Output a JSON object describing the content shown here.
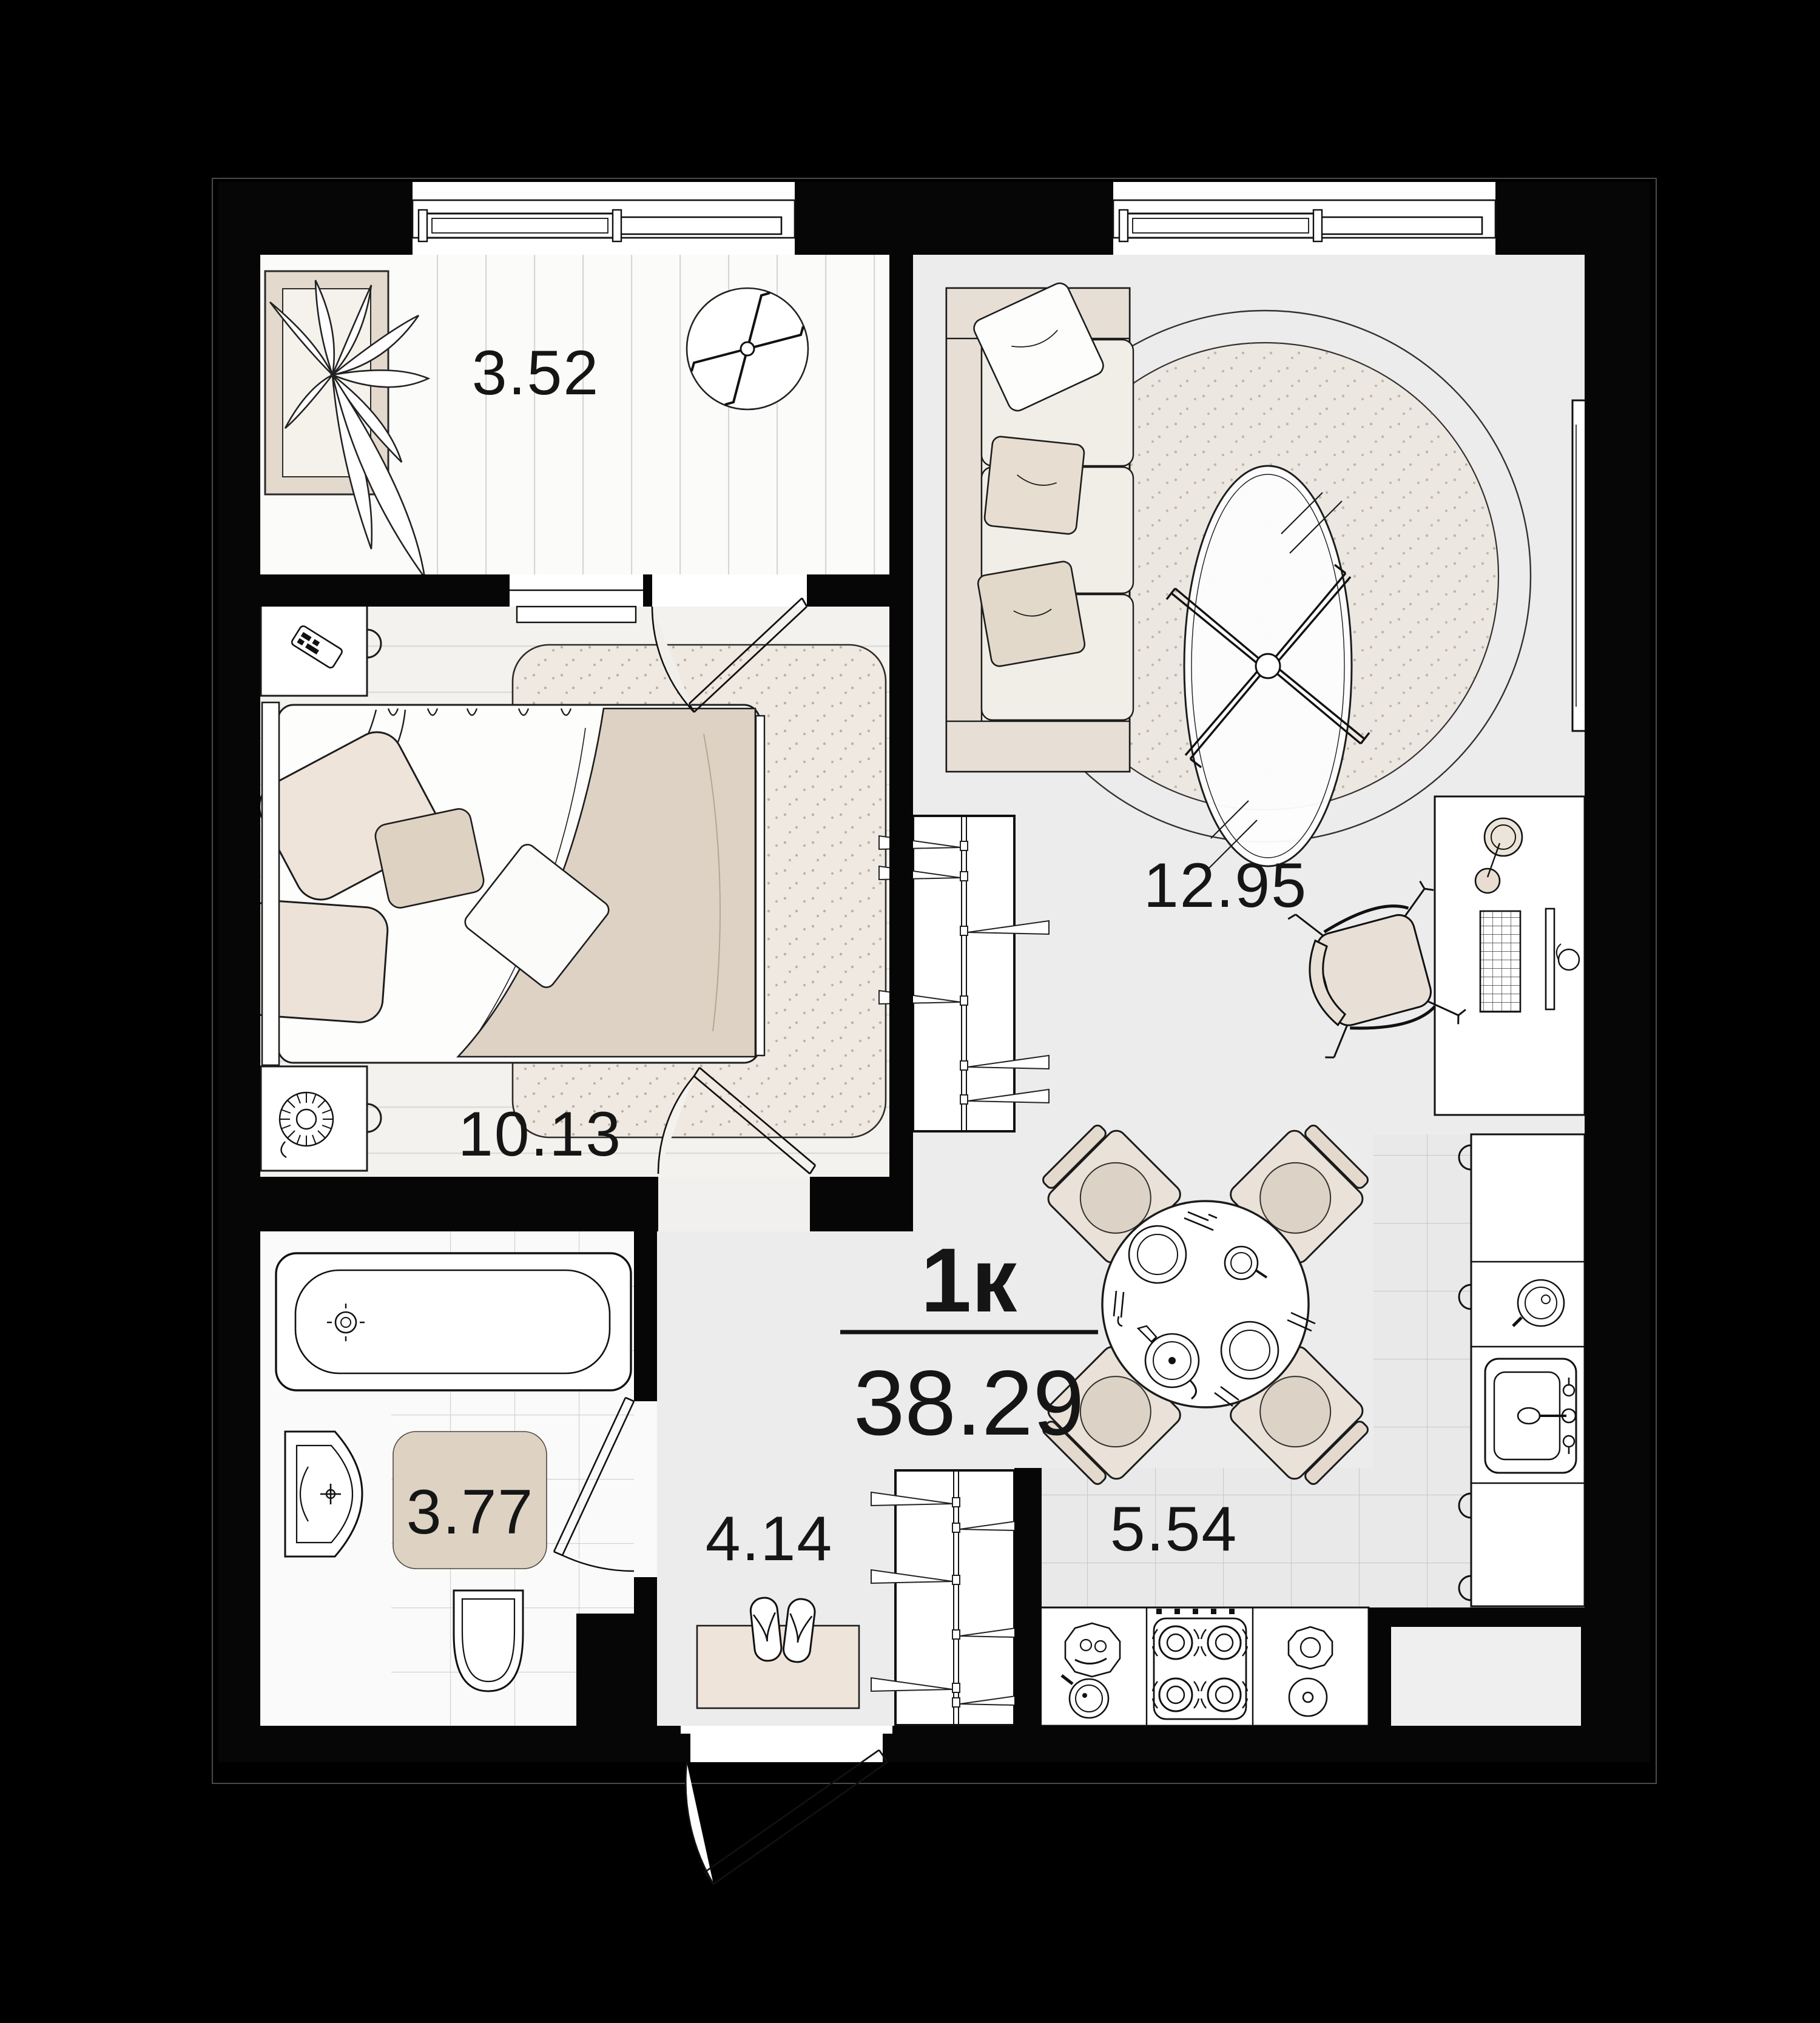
{
  "plan": {
    "title": {
      "type_label": "1к",
      "total_area": "38.29"
    },
    "rooms": [
      {
        "id": "balcony",
        "area": "3.52"
      },
      {
        "id": "bedroom",
        "area": "10.13"
      },
      {
        "id": "living_room",
        "area": "12.95"
      },
      {
        "id": "bathroom",
        "area": "3.77"
      },
      {
        "id": "hallway",
        "area": "4.14"
      },
      {
        "id": "kitchen",
        "area": "5.54"
      }
    ],
    "colors": {
      "background": "#000000",
      "wall": "#060606",
      "floor_gray": "#ececec",
      "floor_wood": "#f3f2ef",
      "tile": "#e9e9e9",
      "beige": "#e7ded3",
      "beige_dark": "#d9cec1",
      "rug_speckle": "#ede7e0",
      "mat": "#ded2c3",
      "line": "#1b1b1b"
    },
    "icons": [
      "plant-icon",
      "ceiling-fan-icon",
      "bed",
      "pillow",
      "nightstand",
      "remote-icon",
      "spiral-coil-icon",
      "wardrobe-hangers",
      "sofa",
      "round-rug",
      "coffee-table",
      "tv-icon",
      "desk",
      "desk-lamp-icon",
      "keyboard-icon",
      "monitor-icon",
      "mouse-icon",
      "office-chair",
      "dining-table",
      "dining-chair",
      "plate-icon",
      "cup-icon",
      "teapot-icon",
      "kitchen-counter",
      "kitchen-sink-icon",
      "cutting-board-icon",
      "stove-burners-icon",
      "bowl-icon",
      "pan-icon",
      "bathtub",
      "washbasin-icon",
      "toilet-icon",
      "bath-mat",
      "hall-rug",
      "slippers-icon",
      "door-swing",
      "window",
      "vent-shaft"
    ]
  }
}
